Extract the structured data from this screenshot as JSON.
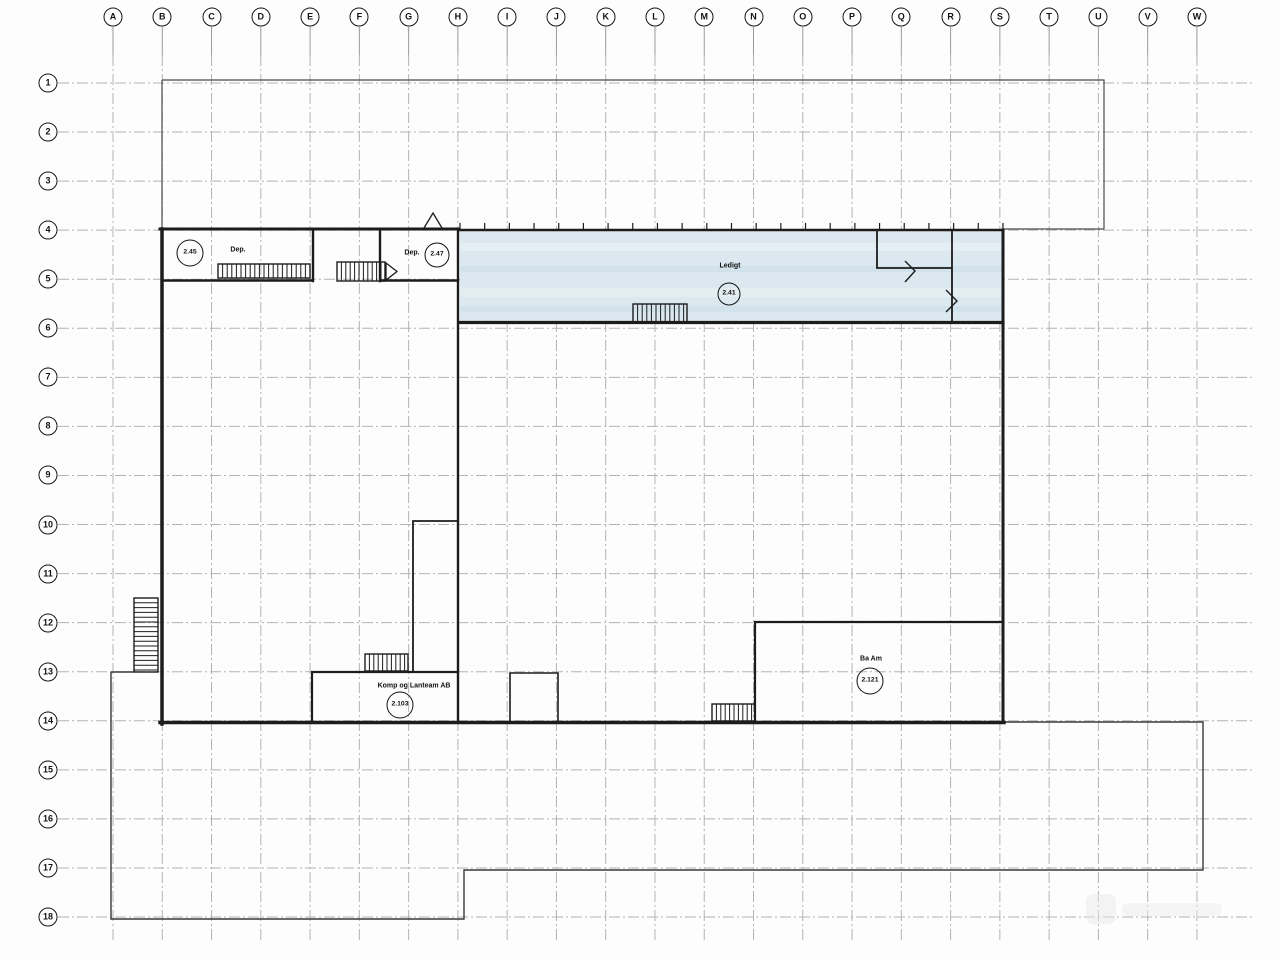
{
  "grid": {
    "columns": [
      "A",
      "B",
      "C",
      "D",
      "E",
      "F",
      "G",
      "H",
      "I",
      "J",
      "K",
      "L",
      "M",
      "N",
      "O",
      "P",
      "Q",
      "R",
      "S",
      "T",
      "U",
      "V",
      "W"
    ],
    "rows": [
      "1",
      "2",
      "3",
      "4",
      "5",
      "6",
      "7",
      "8",
      "9",
      "10",
      "11",
      "12",
      "13",
      "14",
      "15",
      "16",
      "17",
      "18"
    ]
  },
  "rooms": {
    "dep_left": {
      "label": "Dep.",
      "number": "2.45"
    },
    "dep_right": {
      "label": "Dep.",
      "number": "2.47"
    },
    "ledigt": {
      "label": "Ledigt",
      "number": "2.41"
    },
    "komp": {
      "label": "Komp og Lanteam AB",
      "number": "2.103"
    },
    "ba_am": {
      "label": "Ba Am",
      "number": "2.121"
    }
  },
  "colors": {
    "highlight_fill": "#dbe8ef",
    "wall": "#1c1c1c",
    "grid_line": "#b3b3b3",
    "outline": "#3a3a3a"
  }
}
